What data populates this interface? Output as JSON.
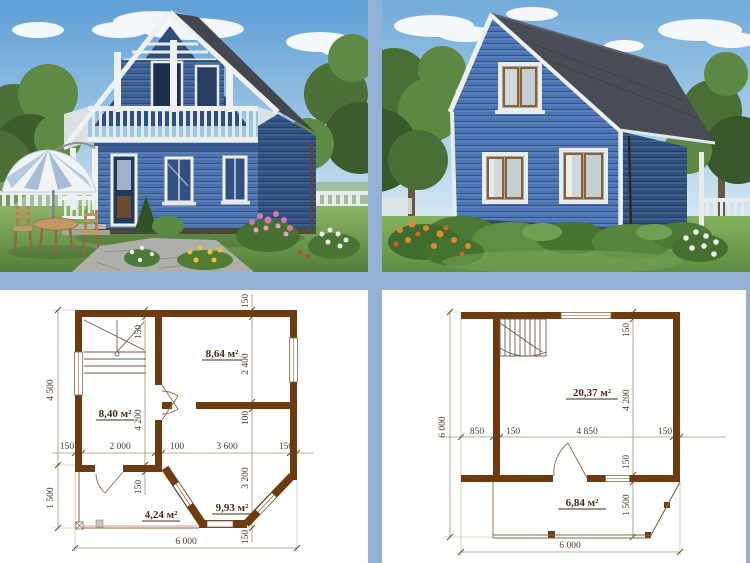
{
  "collage": {
    "title": "House project 6x6 with two photo renders and two floor plans",
    "colors": {
      "divider": "#92b1d4",
      "siding_blue": "#4a72b2",
      "roof_gray": "#484d55",
      "trim_white": "#eef1f0",
      "plan_wall_brown": "#6e3a10",
      "plan_text_brown": "#4f3828"
    }
  },
  "plan1": {
    "rooms": {
      "a": "8,64 м²",
      "b": "8,40 м²",
      "c": "4,24 м²",
      "d": "9,93 м²"
    },
    "dims": {
      "left_upper": "4 500",
      "left_lower": "1 500",
      "mid1": "150",
      "mid2": "2 000",
      "mid3": "100",
      "mid4": "3 600",
      "mid5": "150",
      "inner1": "150",
      "inner2": "4 200",
      "inner3": "150",
      "col1": "150",
      "col2": "2 400",
      "col3": "100",
      "col4": "3 200",
      "col5": "150",
      "total_width": "6 000"
    }
  },
  "plan2": {
    "rooms": {
      "main": "20,37 м²",
      "lower": "6,84 м²"
    },
    "dims": {
      "left_total": "6 000",
      "mid1": "850",
      "mid2": "150",
      "mid3": "4 850",
      "mid4": "150",
      "right1": "150",
      "right2": "4 200",
      "right3": "150",
      "right4": "1 500",
      "total_width": "6 000"
    }
  }
}
